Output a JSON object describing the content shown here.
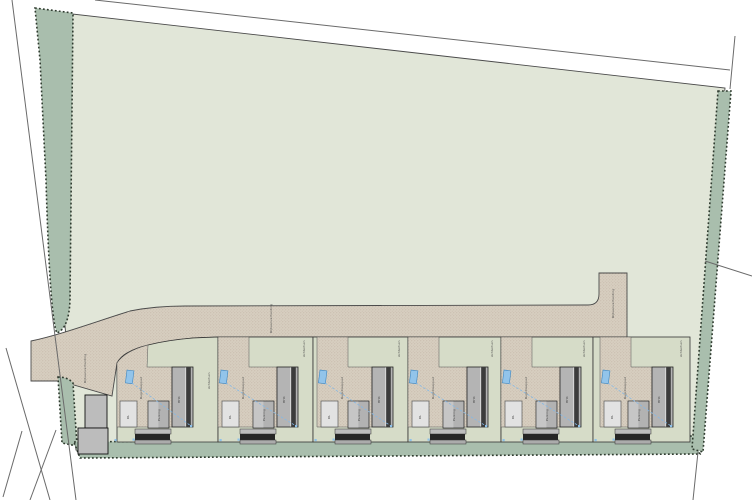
{
  "document": {
    "type": "landscape-site-plan",
    "background": "#ffffff"
  },
  "colors": {
    "field": "#e1e6d8",
    "lot_green": "#d6dcc8",
    "hedge": "#a9bead",
    "hedge_edge": "#2f3b2f",
    "road": "#d7cec0",
    "road_dot": "#b5a globe892",
    "outline": "#4a4a4a",
    "house": "#b4b4b4",
    "house_dark": "#3c3c3c",
    "outbuilding": "#b2b2b2",
    "outbuilding_light": "#c6c6c6",
    "shed": "#e2e2e2",
    "terrace_light": "#bdbdbd",
    "terrace_dark": "#262626",
    "building_west": "#bcbcbc",
    "marker_blue": "#92c4ea",
    "marker_blue_border": "#3e86c0",
    "dashed_blue": "#85b8e5"
  },
  "road": {
    "main_label": "Rijbaanverharding",
    "branch_label": "Rijbaanverharding",
    "west_label": "Rijbaanverharding"
  },
  "lot_labels": {
    "driveway": "Rugstreeppad",
    "house": "HH4",
    "outbuilding": "Parking",
    "shed": "DL",
    "garden": "Achtertuin"
  },
  "lots": [
    {
      "name": "kavel-1",
      "x": 113,
      "w": 105,
      "d": 3,
      "bx": 14,
      "gy": 52,
      "curved": true
    },
    {
      "name": "kavel-2",
      "x": 218,
      "w": 95,
      "d": 0,
      "bx": 3,
      "gy": 20,
      "curved": false
    },
    {
      "name": "kavel-3",
      "x": 313,
      "w": 95,
      "d": 4,
      "bx": 7,
      "gy": 20,
      "curved": false
    },
    {
      "name": "kavel-4",
      "x": 408,
      "w": 93,
      "d": 0,
      "bx": 3,
      "gy": 20,
      "curved": false
    },
    {
      "name": "kavel-5",
      "x": 501,
      "w": 92,
      "d": 0,
      "bx": 3,
      "gy": 20,
      "curved": false
    },
    {
      "name": "kavel-6",
      "x": 593,
      "w": 97,
      "d": 7,
      "bx": 10,
      "gy": 20,
      "curved": false
    }
  ]
}
